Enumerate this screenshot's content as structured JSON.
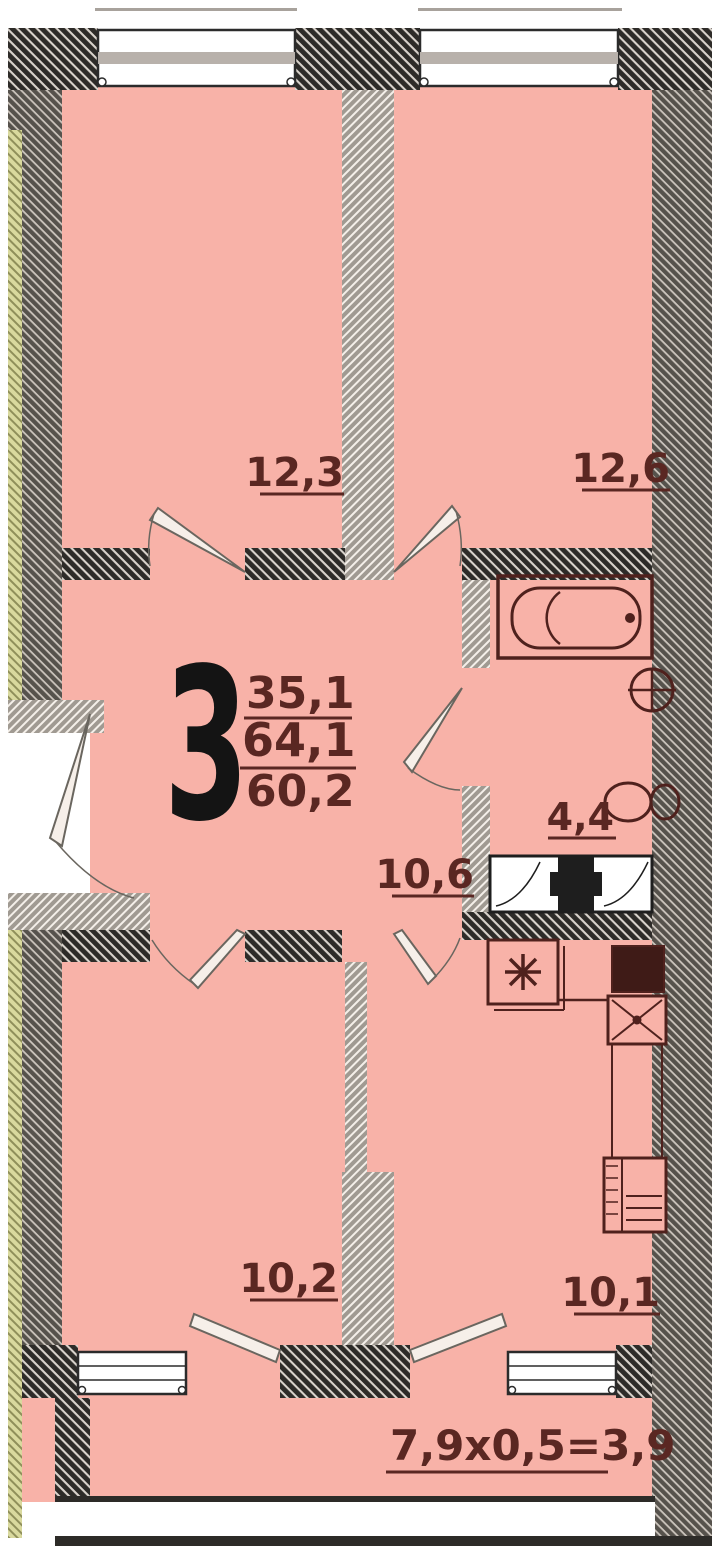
{
  "floorplan": {
    "type": "apartment-floor-plan",
    "unit": {
      "rooms_count": "3",
      "living_area": "35,1",
      "total_area": "64,1",
      "reduced_area": "60,2"
    },
    "rooms": [
      {
        "name": "bedroom-top-left",
        "area": "12,3"
      },
      {
        "name": "bedroom-top-right",
        "area": "12,6"
      },
      {
        "name": "bathroom",
        "area": "4,4"
      },
      {
        "name": "hallway",
        "area": "10,6"
      },
      {
        "name": "bedroom-bottom-left",
        "area": "10,2"
      },
      {
        "name": "kitchen",
        "area": "10,1"
      }
    ],
    "balcony": {
      "formula": "7,9x0,5=3,9"
    },
    "icons": [
      "bathtub-icon",
      "washbasin-icon",
      "toilet-icon",
      "vent-shaft-icon",
      "boiler-icon",
      "stove-icon",
      "kitchen-sink-icon",
      "fridge-icon",
      "window-icon",
      "door-leaf-icon"
    ],
    "colors": {
      "floor_pink": "#f8b2a8",
      "wall_dark": "#2d2b28",
      "wall_outer": "#56524c",
      "wall_partition": "#a09a92",
      "wall_accent_yellow": "#d9d99e",
      "label_text": "#5a2722",
      "big_number": "#141414",
      "fixture_stroke": "#4f211d",
      "window_gray": "#b8b1ab"
    }
  }
}
